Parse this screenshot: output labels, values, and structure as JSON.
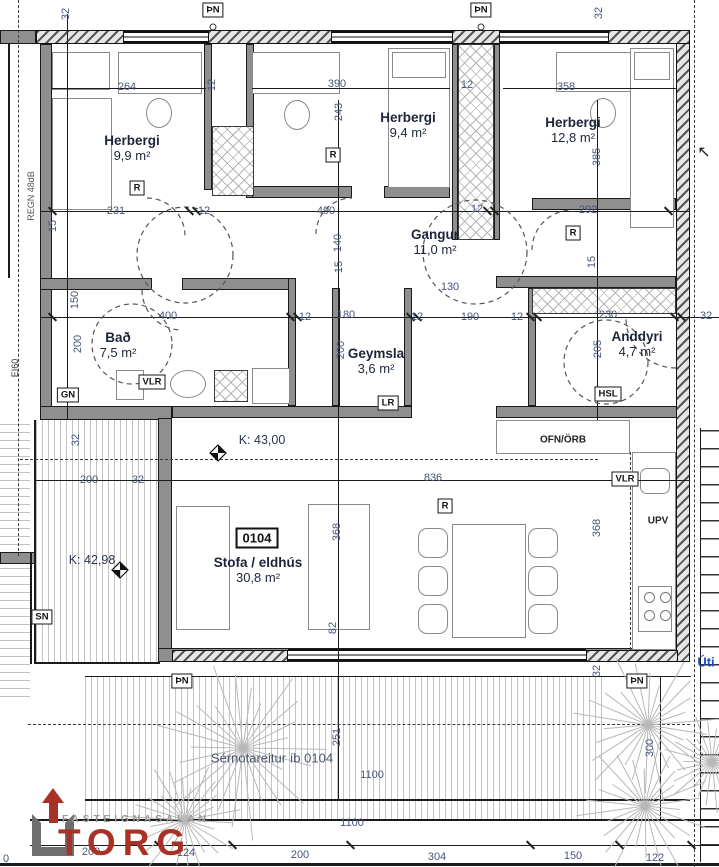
{
  "unit": {
    "number": "0104"
  },
  "misc": {
    "entrance_arrow": "↖"
  },
  "logo": {
    "top": "FASTEIGNASALAN",
    "name": "TORG",
    "name_color": "#a93226",
    "top_color": "#9a9a9a"
  },
  "rooms": [
    {
      "name": "Herbergi",
      "area": "9,9 m²",
      "x": 132,
      "y": 148
    },
    {
      "name": "Herbergi",
      "area": "9,4 m²",
      "x": 408,
      "y": 125
    },
    {
      "name": "Herbergi",
      "area": "12,8 m²",
      "x": 573,
      "y": 130
    },
    {
      "name": "Gangur",
      "area": "11,0 m²",
      "x": 435,
      "y": 242
    },
    {
      "name": "Bað",
      "area": "7,5 m²",
      "x": 118,
      "y": 345
    },
    {
      "name": "Geymsla",
      "area": "3,6 m²",
      "x": 376,
      "y": 361
    },
    {
      "name": "Anddyri",
      "area": "4,7 m²",
      "x": 637,
      "y": 344
    },
    {
      "name": "Stofa / eldhús",
      "area": "30,8 m²",
      "x": 258,
      "y": 570
    }
  ],
  "levels": [
    {
      "label": "K: 43,00",
      "x": 262,
      "y": 440
    },
    {
      "label": "K: 42,98",
      "x": 92,
      "y": 560
    }
  ],
  "tags": [
    {
      "text": "ÞN",
      "x": 213,
      "y": 10
    },
    {
      "text": "ÞN",
      "x": 481,
      "y": 10
    },
    {
      "text": "ÞN",
      "x": 182,
      "y": 681
    },
    {
      "text": "ÞN",
      "x": 637,
      "y": 681
    },
    {
      "text": "R",
      "x": 137,
      "y": 188
    },
    {
      "text": "R",
      "x": 333,
      "y": 155
    },
    {
      "text": "R",
      "x": 573,
      "y": 233
    },
    {
      "text": "R",
      "x": 445,
      "y": 506
    },
    {
      "text": "VLR",
      "x": 152,
      "y": 382
    },
    {
      "text": "VLR",
      "x": 625,
      "y": 479
    },
    {
      "text": "GN",
      "x": 68,
      "y": 395
    },
    {
      "text": "SN",
      "x": 42,
      "y": 617
    },
    {
      "text": "LR",
      "x": 388,
      "y": 403
    },
    {
      "text": "HSL",
      "x": 608,
      "y": 394
    }
  ],
  "labels": [
    {
      "text": "OFN/ÖRB",
      "x": 563,
      "y": 440,
      "size": 10,
      "bold": true,
      "color": "#222"
    },
    {
      "text": "UPV",
      "x": 658,
      "y": 521,
      "size": 10,
      "bold": true,
      "color": "#222"
    },
    {
      "text": "Úti",
      "x": 706,
      "y": 662,
      "size": 13,
      "bold": true,
      "color": "#1f4fc0"
    },
    {
      "text": "Sérnotareitur íb 0104",
      "x": 272,
      "y": 758,
      "size": 13,
      "bold": false,
      "color": "#4a5570"
    },
    {
      "text": "REGN 48dB",
      "x": 31,
      "y": 196,
      "size": 9,
      "bold": false,
      "color": "#555",
      "rot": true
    },
    {
      "text": "EI60",
      "x": 15,
      "y": 368,
      "size": 9,
      "bold": false,
      "color": "#333",
      "rot": true
    }
  ],
  "dimensions": [
    {
      "t": "32",
      "x": 66,
      "y": 14,
      "r": 1
    },
    {
      "t": "264",
      "x": 127,
      "y": 87
    },
    {
      "t": "12",
      "x": 212,
      "y": 85,
      "r": 1
    },
    {
      "t": "390",
      "x": 337,
      "y": 84
    },
    {
      "t": "243",
      "x": 339,
      "y": 112,
      "r": 1
    },
    {
      "t": "12",
      "x": 467,
      "y": 85
    },
    {
      "t": "358",
      "x": 566,
      "y": 87
    },
    {
      "t": "32",
      "x": 599,
      "y": 13,
      "r": 1
    },
    {
      "t": "385",
      "x": 597,
      "y": 157,
      "r": 1
    },
    {
      "t": "231",
      "x": 116,
      "y": 211
    },
    {
      "t": "12",
      "x": 204,
      "y": 211
    },
    {
      "t": "490",
      "x": 326,
      "y": 211
    },
    {
      "t": "12",
      "x": 477,
      "y": 209
    },
    {
      "t": "292",
      "x": 588,
      "y": 210
    },
    {
      "t": "15",
      "x": 53,
      "y": 226,
      "r": 1
    },
    {
      "t": "140",
      "x": 338,
      "y": 243,
      "r": 1
    },
    {
      "t": "15",
      "x": 339,
      "y": 267,
      "r": 1
    },
    {
      "t": "130",
      "x": 450,
      "y": 287
    },
    {
      "t": "15",
      "x": 592,
      "y": 262,
      "r": 1
    },
    {
      "t": "400",
      "x": 168,
      "y": 316
    },
    {
      "t": "12",
      "x": 305,
      "y": 317
    },
    {
      "t": "180",
      "x": 346,
      "y": 315
    },
    {
      "t": "12",
      "x": 417,
      "y": 317
    },
    {
      "t": "190",
      "x": 470,
      "y": 317
    },
    {
      "t": "12",
      "x": 517,
      "y": 317
    },
    {
      "t": "230",
      "x": 608,
      "y": 315
    },
    {
      "t": "32",
      "x": 706,
      "y": 316
    },
    {
      "t": "150",
      "x": 75,
      "y": 300,
      "r": 1
    },
    {
      "t": "200",
      "x": 78,
      "y": 344,
      "r": 1
    },
    {
      "t": "200",
      "x": 341,
      "y": 350,
      "r": 1
    },
    {
      "t": "205",
      "x": 598,
      "y": 349,
      "r": 1
    },
    {
      "t": "32",
      "x": 76,
      "y": 440,
      "r": 1
    },
    {
      "t": "200",
      "x": 89,
      "y": 480
    },
    {
      "t": "32",
      "x": 138,
      "y": 480
    },
    {
      "t": "836",
      "x": 433,
      "y": 478
    },
    {
      "t": "368",
      "x": 337,
      "y": 532,
      "r": 1
    },
    {
      "t": "368",
      "x": 597,
      "y": 528,
      "r": 1
    },
    {
      "t": "82",
      "x": 333,
      "y": 628,
      "r": 1
    },
    {
      "t": "32",
      "x": 597,
      "y": 671,
      "r": 1
    },
    {
      "t": "251",
      "x": 337,
      "y": 737,
      "r": 1
    },
    {
      "t": "300",
      "x": 650,
      "y": 748,
      "r": 1
    },
    {
      "t": "1100",
      "x": 372,
      "y": 775
    },
    {
      "t": "1100",
      "x": 352,
      "y": 823
    },
    {
      "t": "200",
      "x": 91,
      "y": 852
    },
    {
      "t": "124",
      "x": 186,
      "y": 853
    },
    {
      "t": "200",
      "x": 300,
      "y": 855
    },
    {
      "t": "304",
      "x": 437,
      "y": 857
    },
    {
      "t": "150",
      "x": 573,
      "y": 856
    },
    {
      "t": "122",
      "x": 655,
      "y": 858
    },
    {
      "t": "0",
      "x": 6,
      "y": 859
    }
  ]
}
